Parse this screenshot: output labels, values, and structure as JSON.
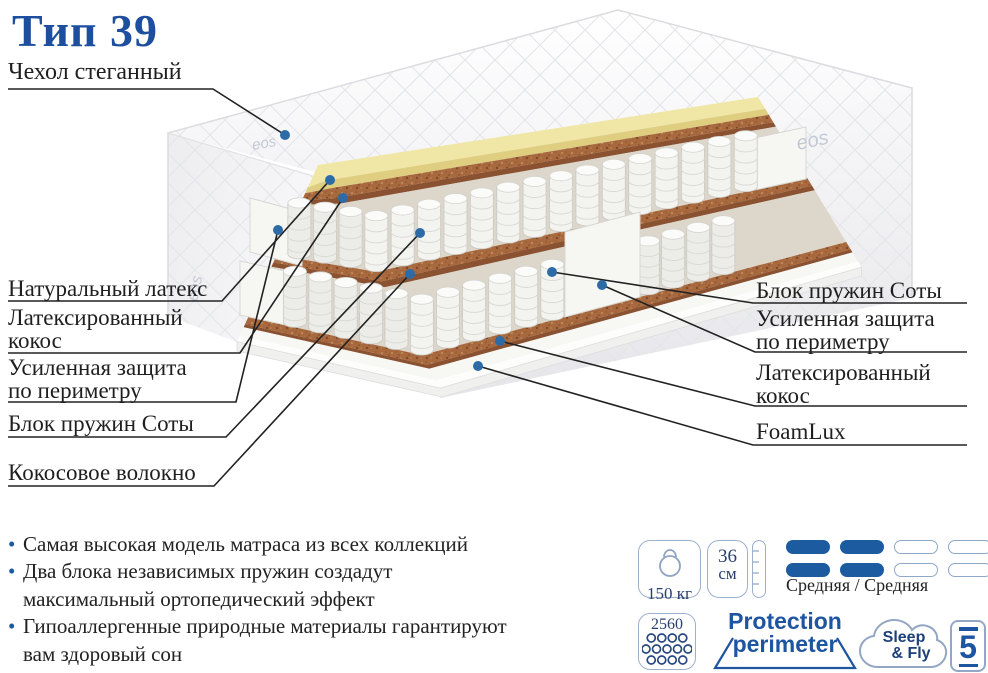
{
  "title": "Тип 39",
  "brand_logo": "eos",
  "callouts": {
    "left": [
      {
        "label": "Чехол стеганный"
      },
      {
        "label": "Натуральный латекс"
      },
      {
        "label": "Латексированный кокос"
      },
      {
        "label": "Усиленная защита по периметру"
      },
      {
        "label": "Блок пружин Соты"
      },
      {
        "label": "Кокосовое волокно"
      }
    ],
    "right": [
      {
        "label": "Блок пружин Соты"
      },
      {
        "label": "Усиленная защита по периметру"
      },
      {
        "label": "Латексированный кокос"
      },
      {
        "label": "FoamLux"
      }
    ]
  },
  "features": [
    {
      "lines": [
        "Самая высокая модель матраса из всех коллекций"
      ]
    },
    {
      "lines": [
        "Два блока независимых пружин создадут",
        "максимальный ортопедический эффект"
      ]
    },
    {
      "lines": [
        "Гипоаллергенные природные материалы гарантируют",
        "вам здоровый сон"
      ]
    }
  ],
  "specs": {
    "max_load": "150 кг",
    "mattress_height_value": "36",
    "mattress_height_unit": "см",
    "firmness_label": "Средняя / Средняя",
    "firmness_level": 2,
    "firmness_max": 4,
    "springs_count": "2560",
    "protection_line1": "Protection",
    "protection_line2": "perimeter",
    "brand_line1": "Sleep",
    "brand_line2": "& Fly",
    "warranty_years": "5"
  },
  "colors": {
    "accent": "#1d55a0",
    "title": "#1d4f9e",
    "callout_line": "#222222",
    "callout_dot": "#2d6ba6",
    "latex": "#f0e6a6",
    "latex_side": "#dfcd80",
    "coconut": "#a8693f",
    "coconut_side": "#8a5230",
    "springs_bg": "#ddd6cb"
  }
}
